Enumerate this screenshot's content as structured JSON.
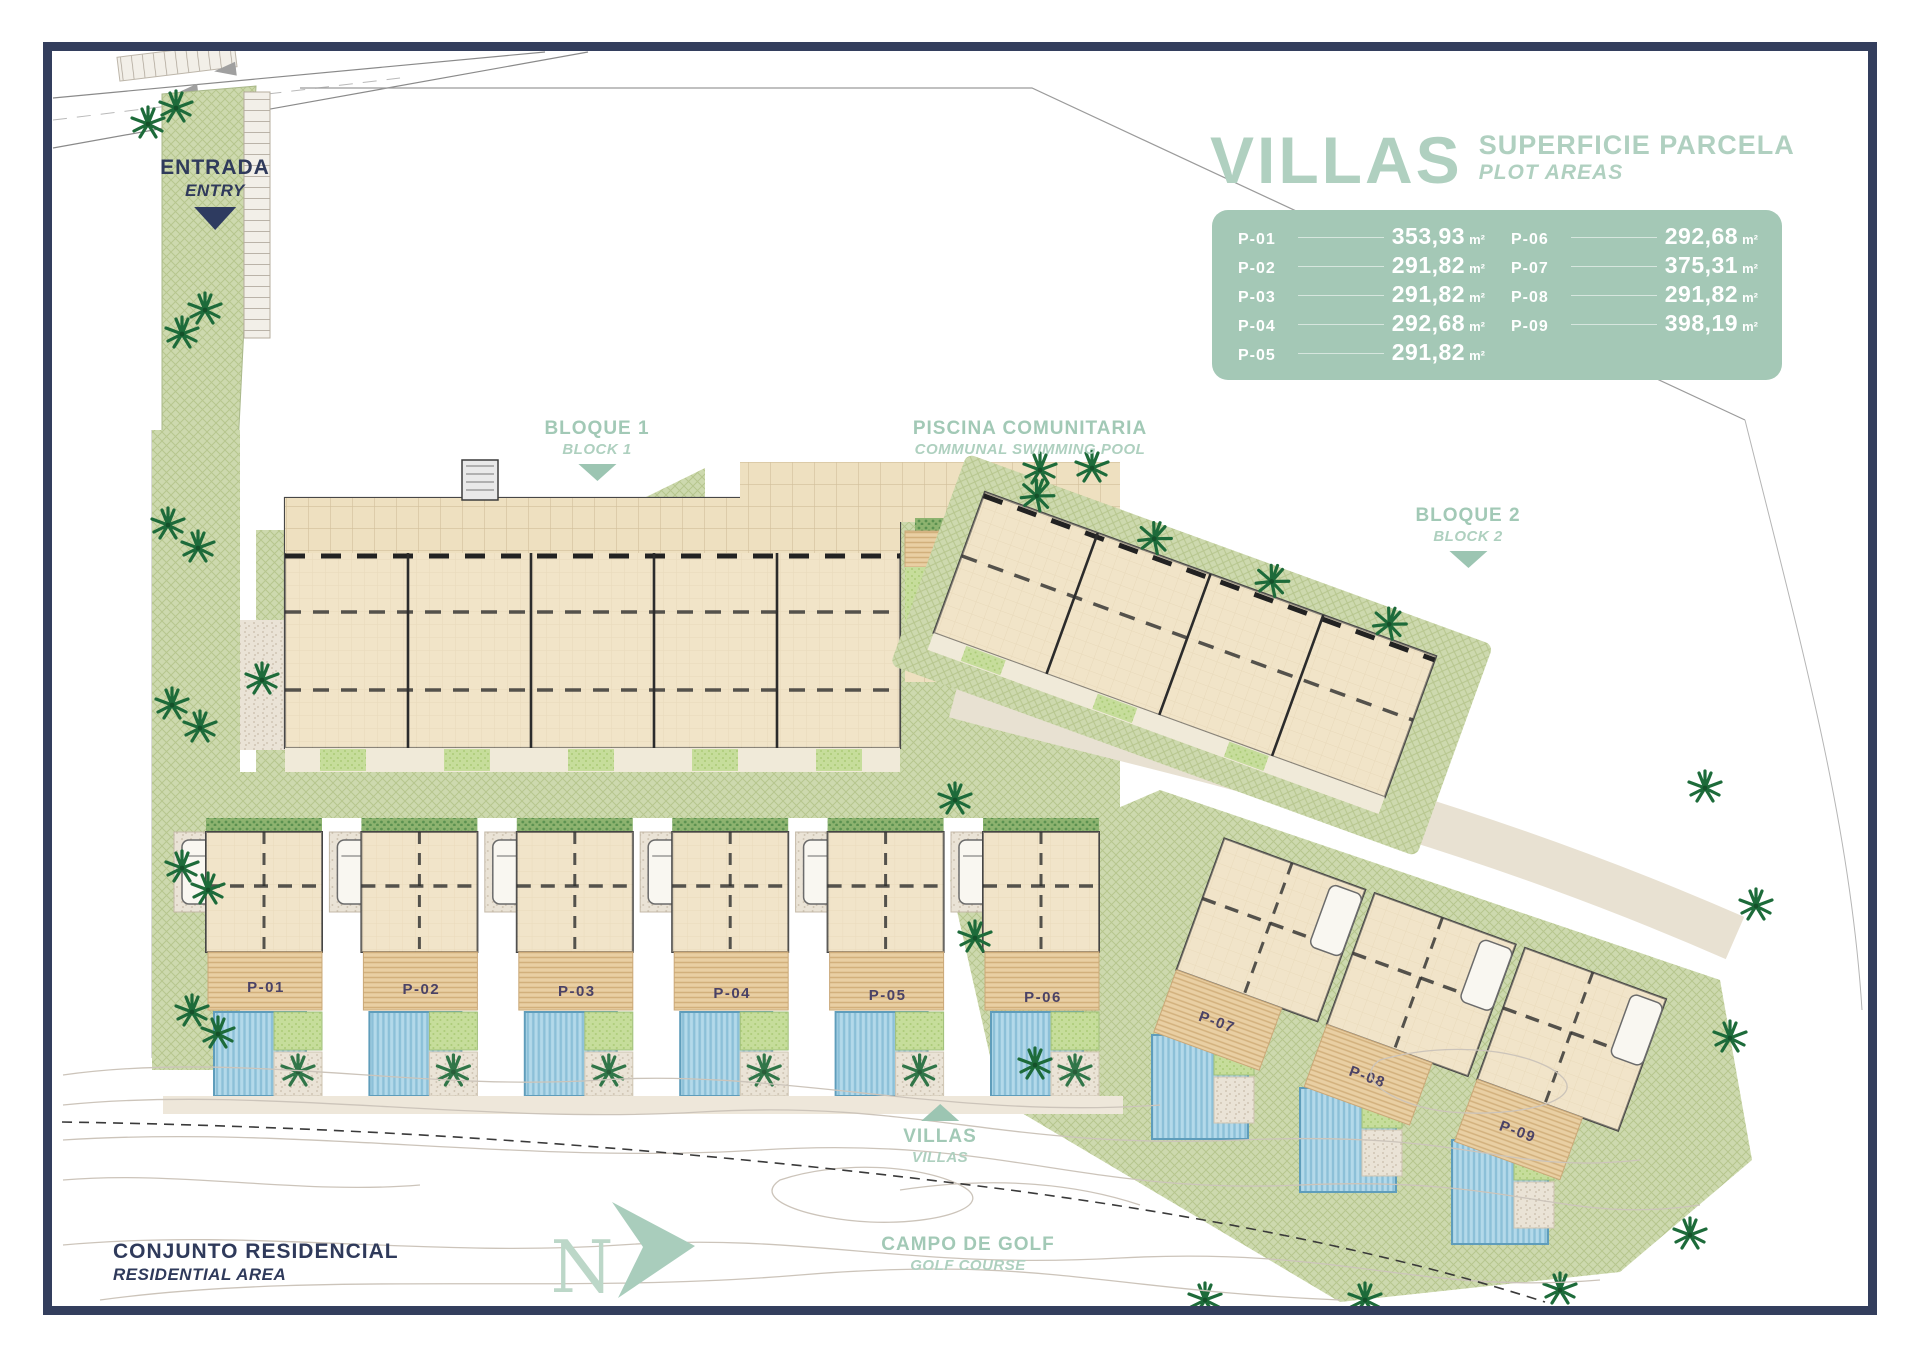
{
  "legend": {
    "title": "VILLAS",
    "subtitle": "SUPERFICIE PARCELA",
    "subtitle_en": "PLOT AREAS",
    "plots": [
      {
        "id": "P-01",
        "area": "353,93",
        "unit": "m²"
      },
      {
        "id": "P-02",
        "area": "291,82",
        "unit": "m²"
      },
      {
        "id": "P-03",
        "area": "291,82",
        "unit": "m²"
      },
      {
        "id": "P-04",
        "area": "292,68",
        "unit": "m²"
      },
      {
        "id": "P-05",
        "area": "291,82",
        "unit": "m²"
      },
      {
        "id": "P-06",
        "area": "292,68",
        "unit": "m²"
      },
      {
        "id": "P-07",
        "area": "375,31",
        "unit": "m²"
      },
      {
        "id": "P-08",
        "area": "291,82",
        "unit": "m²"
      },
      {
        "id": "P-09",
        "area": "398,19",
        "unit": "m²"
      }
    ]
  },
  "labels": {
    "entrance": {
      "primary": "ENTRADA",
      "secondary": "ENTRY"
    },
    "block1": {
      "primary": "BLOQUE 1",
      "secondary": "BLOCK 1"
    },
    "pool": {
      "primary": "PISCINA COMUNITARIA",
      "secondary": "COMMUNAL SWIMMING POOL"
    },
    "block2": {
      "primary": "BLOQUE 2",
      "secondary": "BLOCK 2"
    },
    "villas": {
      "primary": "VILLAS",
      "secondary": "VILLAS"
    },
    "residential": {
      "primary": "CONJUNTO RESIDENCIAL",
      "secondary": "RESIDENTIAL AREA"
    },
    "golf": {
      "primary": "CAMPO DE GOLF",
      "secondary": "GOLF COURSE"
    },
    "north": "N"
  },
  "colors": {
    "frame_navy": "#333e5d",
    "accent_sage": "#a4c8b6",
    "text_navy": "#2f3a5b",
    "landscape_green": "#cdd9ae",
    "pool_blue": "#b3d9ea",
    "building_tan": "#f2e5ca",
    "palm_green": "#1d6b3a",
    "marker_purple": "#4a4266"
  }
}
